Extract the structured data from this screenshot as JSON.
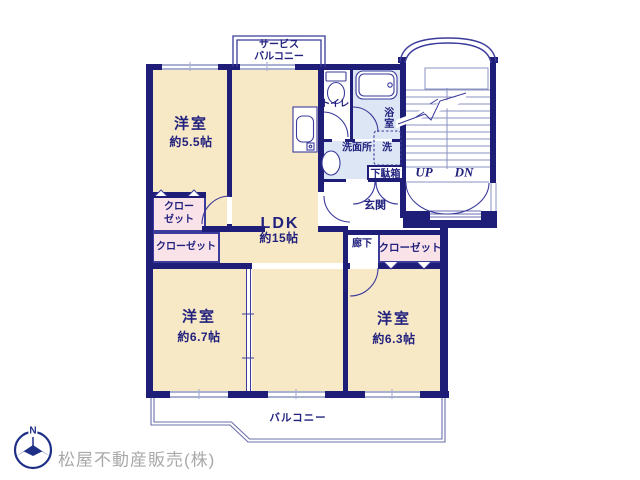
{
  "plan": {
    "rooms": [
      {
        "name": "洋室",
        "size": "約5.5帖"
      },
      {
        "name": "LDK",
        "size": "約15帖"
      },
      {
        "name": "洋室",
        "size": "約6.7帖"
      },
      {
        "name": "洋室",
        "size": "約6.3帖"
      }
    ],
    "closets": [
      {
        "line1": "クロー",
        "line2": "ゼット"
      },
      {
        "label": "クローゼット"
      },
      {
        "label": "クローゼット"
      }
    ],
    "labels": {
      "service_balcony_line1": "サービス",
      "service_balcony_line2": "バルコニー",
      "toilet": "トイレ",
      "bath": "浴室",
      "washroom": "洗面所",
      "washer": "洗",
      "shoe_cabinet": "下駄箱",
      "entrance": "玄関",
      "hallway": "廊下",
      "up": "UP",
      "down": "DN",
      "balcony": "バルコニー"
    },
    "compass_north": "N",
    "company": "松屋不動産販売(株)",
    "colors": {
      "wall": "#1e1e78",
      "room": "#f8e9c6",
      "closet": "#f9e2e8",
      "wet": "#dce6f4",
      "line": "#3b3b9b",
      "window_frame": "#a9b0d2",
      "text": "#22227e",
      "company_text": "#a9a9a9",
      "stair_line": "#8a90c0",
      "compass": "#1d2f86"
    }
  }
}
